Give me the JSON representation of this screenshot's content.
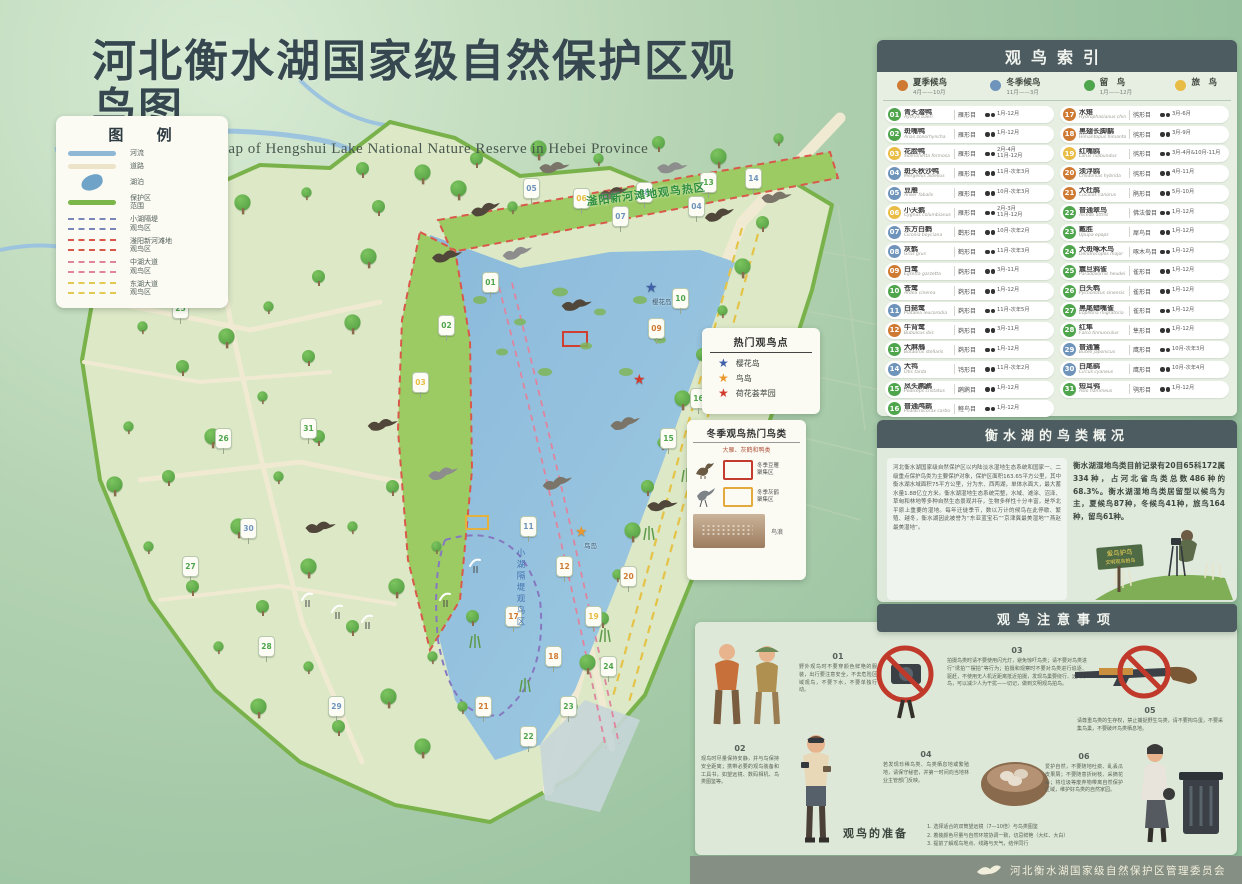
{
  "page": {
    "title": "河北衡水湖国家级自然保护区观鸟图",
    "subtitle": "Bird watching map of Hengshui Lake National Nature Reserve in Hebei Province"
  },
  "colors": {
    "summer": "#cf7a33",
    "winter": "#6f94bb",
    "resident": "#4ea54c",
    "passage": "#e9bd45",
    "header_bar": "#4d5c60",
    "reserve_boundary": "#79b24a",
    "lake": "#8ab9da"
  },
  "legend": {
    "title": "图  例",
    "items": [
      {
        "label": "河流",
        "type": "line",
        "color": "#8fb8d4"
      },
      {
        "label": "道路",
        "type": "line",
        "color": "#ece3c8"
      },
      {
        "label": "湖泊",
        "type": "blob",
        "color": "#6fa3c8"
      },
      {
        "label": "保护区\n范围",
        "type": "line",
        "color": "#7ab648"
      },
      {
        "label": "小湖隔堤\n观鸟区",
        "type": "dash",
        "color": "#7a86b8"
      },
      {
        "label": "滏阳新河滩地\n观鸟区",
        "type": "dash",
        "color": "#d9584a"
      },
      {
        "label": "中湖大道\n观鸟区",
        "type": "dash",
        "color": "#e0849e"
      },
      {
        "label": "东湖大道\n观鸟区",
        "type": "dash",
        "color": "#e2ca52"
      }
    ]
  },
  "map": {
    "labels": {
      "fuyang": "滏阳新河滩地观鸟热区",
      "xiaohu": "小湖隔堤观鸟区",
      "yinghua": "樱花岛",
      "niaodao": "鸟岛"
    },
    "markers": [
      {
        "n": "01",
        "x": 482,
        "y": 272
      },
      {
        "n": "02",
        "x": 438,
        "y": 315
      },
      {
        "n": "03",
        "x": 412,
        "y": 372
      },
      {
        "n": "04",
        "x": 688,
        "y": 196
      },
      {
        "n": "05",
        "x": 523,
        "y": 178
      },
      {
        "n": "06",
        "x": 573,
        "y": 188
      },
      {
        "n": "07",
        "x": 612,
        "y": 206
      },
      {
        "n": "08",
        "x": 636,
        "y": 182
      },
      {
        "n": "09",
        "x": 648,
        "y": 318
      },
      {
        "n": "10",
        "x": 672,
        "y": 288
      },
      {
        "n": "11",
        "x": 520,
        "y": 516
      },
      {
        "n": "12",
        "x": 556,
        "y": 556
      },
      {
        "n": "13",
        "x": 700,
        "y": 172
      },
      {
        "n": "14",
        "x": 745,
        "y": 168
      },
      {
        "n": "15",
        "x": 660,
        "y": 428
      },
      {
        "n": "16",
        "x": 690,
        "y": 388
      },
      {
        "n": "17",
        "x": 505,
        "y": 606
      },
      {
        "n": "18",
        "x": 545,
        "y": 646
      },
      {
        "n": "19",
        "x": 585,
        "y": 606
      },
      {
        "n": "20",
        "x": 620,
        "y": 566
      },
      {
        "n": "21",
        "x": 475,
        "y": 696
      },
      {
        "n": "22",
        "x": 520,
        "y": 726
      },
      {
        "n": "23",
        "x": 560,
        "y": 696
      },
      {
        "n": "24",
        "x": 600,
        "y": 656
      },
      {
        "n": "25",
        "x": 172,
        "y": 298
      },
      {
        "n": "26",
        "x": 215,
        "y": 428
      },
      {
        "n": "27",
        "x": 182,
        "y": 556
      },
      {
        "n": "28",
        "x": 258,
        "y": 636
      },
      {
        "n": "29",
        "x": 328,
        "y": 696
      },
      {
        "n": "30",
        "x": 240,
        "y": 518
      },
      {
        "n": "31",
        "x": 300,
        "y": 418
      }
    ],
    "stars": [
      {
        "x": 645,
        "y": 281,
        "color": "#3f5fa8"
      },
      {
        "x": 575,
        "y": 525,
        "color": "#e8982c"
      },
      {
        "x": 633,
        "y": 373,
        "color": "#d23a2e"
      }
    ]
  },
  "hotspot": {
    "title": "热门观鸟点",
    "items": [
      {
        "label": "樱花岛",
        "color": "#3f5fa8"
      },
      {
        "label": "鸟岛",
        "color": "#e8982c"
      },
      {
        "label": "荷花荟萃园",
        "color": "#d23a2e"
      }
    ]
  },
  "winter": {
    "title": "冬季观鸟热门鸟类",
    "subtitle": "大雁、灰鹤和鸭类",
    "items": [
      {
        "label": "冬季豆雁\n聚集区",
        "color": "#c23b2e",
        "icon": "goose"
      },
      {
        "label": "冬季灰鹤\n聚集区",
        "color": "#e4a93c",
        "icon": "crane"
      }
    ],
    "photo_label": "鸟浪"
  },
  "index": {
    "title": "观鸟索引",
    "seasons": [
      {
        "label": "夏季候鸟",
        "dates": "4月——10月",
        "season": "summer"
      },
      {
        "label": "冬季候鸟",
        "dates": "11月——3月",
        "season": "winter"
      },
      {
        "label": "留　鸟",
        "dates": "1月——12月",
        "season": "resident"
      },
      {
        "label": "旅　鸟",
        "dates": "",
        "season": "passage"
      }
    ],
    "birds": [
      {
        "no": "01",
        "name": "青头潜鸭",
        "latin": "Aythya baeri",
        "order": "雁形目",
        "months": "1月-12月",
        "season": "resident"
      },
      {
        "no": "02",
        "name": "斑嘴鸭",
        "latin": "Anas zonorhyncha",
        "order": "雁形目",
        "months": "1月-12月",
        "season": "resident"
      },
      {
        "no": "03",
        "name": "花脸鸭",
        "latin": "Sibirionetta formosa",
        "order": "雁形目",
        "months": "2月-4月\n11月-12月",
        "season": "passage"
      },
      {
        "no": "04",
        "name": "斑头秋沙鸭",
        "latin": "Mergellus albellus",
        "order": "雁形目",
        "months": "11月-次年3月",
        "season": "winter"
      },
      {
        "no": "05",
        "name": "豆雁",
        "latin": "Anser fabalis",
        "order": "雁形目",
        "months": "10月-次年3月",
        "season": "winter"
      },
      {
        "no": "06",
        "name": "小天鹅",
        "latin": "Cygnus columbianus",
        "order": "雁形目",
        "months": "2月-3月\n11月-12月",
        "season": "passage"
      },
      {
        "no": "07",
        "name": "东方白鹳",
        "latin": "Ciconia boyciana",
        "order": "鹳形目",
        "months": "10月-次年2月",
        "season": "winter"
      },
      {
        "no": "08",
        "name": "灰鹤",
        "latin": "Grus grus",
        "order": "鹤形目",
        "months": "11月-次年3月",
        "season": "winter"
      },
      {
        "no": "09",
        "name": "白鹭",
        "latin": "Egretta garzetta",
        "order": "鹈形目",
        "months": "3月-11月",
        "season": "summer"
      },
      {
        "no": "10",
        "name": "苍鹭",
        "latin": "Ardea cinerea",
        "order": "鹈形目",
        "months": "1月-12月",
        "season": "resident"
      },
      {
        "no": "11",
        "name": "白琵鹭",
        "latin": "Platalea leucorodia",
        "order": "鹈形目",
        "months": "11月-次年5月",
        "season": "winter"
      },
      {
        "no": "12",
        "name": "牛背鹭",
        "latin": "Bubulcus ibis",
        "order": "鹈形目",
        "months": "3月-11月",
        "season": "summer"
      },
      {
        "no": "13",
        "name": "大麻鳽",
        "latin": "Botaurus stellaris",
        "order": "鹈形目",
        "months": "1月-12月",
        "season": "resident"
      },
      {
        "no": "14",
        "name": "大鸨",
        "latin": "Otis tarda",
        "order": "鸨形目",
        "months": "11月-次年2月",
        "season": "winter"
      },
      {
        "no": "15",
        "name": "凤头䴙䴘",
        "latin": "Podiceps cristatus",
        "order": "䴙䴘目",
        "months": "1月-12月",
        "season": "resident"
      },
      {
        "no": "16",
        "name": "普通鸬鹚",
        "latin": "Phalacrocorax carbo",
        "order": "鲣鸟目",
        "months": "1月-12月",
        "season": "resident"
      },
      {
        "no": "17",
        "name": "水雉",
        "latin": "Hydrophasianus chirurgus",
        "order": "鸻形目",
        "months": "3月-6月",
        "season": "summer"
      },
      {
        "no": "18",
        "name": "黑翅长脚鹬",
        "latin": "Himantopus himantopus",
        "order": "鸻形目",
        "months": "3月-9月",
        "season": "summer"
      },
      {
        "no": "19",
        "name": "红嘴鸥",
        "latin": "Larus ridibundus",
        "order": "鸻形目",
        "months": "3月-4月&10月-11月",
        "season": "passage"
      },
      {
        "no": "20",
        "name": "须浮鸥",
        "latin": "Chlidonias hybrida",
        "order": "鸻形目",
        "months": "4月-11月",
        "season": "summer"
      },
      {
        "no": "21",
        "name": "大杜鹃",
        "latin": "Cuculus canorus",
        "order": "鹃形目",
        "months": "5月-10月",
        "season": "summer"
      },
      {
        "no": "22",
        "name": "普通翠鸟",
        "latin": "Alcedo atthis",
        "order": "佛法僧目",
        "months": "1月-12月",
        "season": "resident"
      },
      {
        "no": "23",
        "name": "戴胜",
        "latin": "Upupa epops",
        "order": "犀鸟目",
        "months": "1月-12月",
        "season": "resident"
      },
      {
        "no": "24",
        "name": "大斑啄木鸟",
        "latin": "Dendrocopos major",
        "order": "啄木鸟目",
        "months": "1月-12月",
        "season": "resident"
      },
      {
        "no": "25",
        "name": "震旦鸦雀",
        "latin": "Paradoxornis heudei",
        "order": "雀形目",
        "months": "1月-12月",
        "season": "resident"
      },
      {
        "no": "26",
        "name": "白头鹎",
        "latin": "Pycnonotus sinensis",
        "order": "雀形目",
        "months": "1月-12月",
        "season": "resident"
      },
      {
        "no": "27",
        "name": "黑尾蜡嘴雀",
        "latin": "Eophona migratoria",
        "order": "雀形目",
        "months": "1月-12月",
        "season": "resident"
      },
      {
        "no": "28",
        "name": "红隼",
        "latin": "Falco tinnunculus",
        "order": "隼形目",
        "months": "1月-12月",
        "season": "resident"
      },
      {
        "no": "29",
        "name": "普通鵟",
        "latin": "Buteo japonicus",
        "order": "鹰形目",
        "months": "10月-次年3月",
        "season": "winter"
      },
      {
        "no": "30",
        "name": "白尾鹞",
        "latin": "Circus cyaneus",
        "order": "鹰形目",
        "months": "10月-次年4月",
        "season": "winter"
      },
      {
        "no": "31",
        "name": "短耳鸮",
        "latin": "Asio flammeus",
        "order": "鸮形目",
        "months": "1月-12月",
        "season": "resident"
      }
    ]
  },
  "overview": {
    "title": "衡水湖的鸟类概况",
    "paragraph": "河北衡水湖国家级自然保护区以内陆淡水湿地生态系统和国家一、二级重点保护鸟类为主要保护对象，保护区面积163.65平方公里，其中衡水湖水域面积75平方公里，分为东、西两湖，单体水面大，最大蓄水量1.88亿立方米。衡水湖湿地生态系统完整，水域、滩涂、沼泽、草甸和林地等多种自然生态景观并存，生物多样性十分丰富，是华北平原上重要的湿地。每年迁徙季节，数以万计的候鸟在此停歇、繁殖、越冬，衡水湖因此被誉为“东亚蓝宝石”“京津冀最美湿地”“燕赵最美湿地”。",
    "stats": "衡水湖湿地鸟类目前记录有20目65科172属334种，占河北省鸟类总数486种的68.3%。衡水湖湿地鸟类居留型以候鸟为主，夏候鸟87种，冬候鸟41种，旅鸟164种，留鸟61种。",
    "sign_line1": "爱鸟护鸟",
    "sign_line2": "文明观鸟拍鸟"
  },
  "notes": {
    "title": "观鸟注意事项",
    "items": [
      {
        "no": "01",
        "text": "野外观鸟时不要穿颜色鲜艳的服装，出行要注意安全，不去危险区域观鸟，不要下水，不要单独行动。"
      },
      {
        "no": "02",
        "text": "观鸟时尽量保持安静，并与鸟保持安全距离；携带必要的观鸟装备和工具书，如望远镜、数码相机、鸟类图鉴等。"
      },
      {
        "no": "03",
        "text": "拍摄鸟类时请不要使用闪光灯，避免惊吓鸟类；请不要对鸟类进行“诱拍”“摆拍”等行为；拍摄和观察时不要对鸟类进行追逐、驱赶，不使用无人机近距离抵近拍摄，发现鸟巢要绕行、远离雏鸟，可以减少人为干扰——切记，做到文明观鸟拍鸟。"
      },
      {
        "no": "04",
        "text": "若发现珍稀鸟类、鸟类栖息地或繁殖地，请保守秘密，并第一时间向当地林业主管部门反映。"
      },
      {
        "no": "05",
        "text": "请尊重鸟类的生存权，禁止捕捉野生鸟类，请不要掏鸟蛋，不要采集鸟巢，不要破坏鸟类栖息地。"
      },
      {
        "no": "06",
        "text": "爱护自然，不要随地吐痰、乱丢瓜皮果屑；不要随意折树枝、采摘花朵；将垃圾等废弃物带离自然保护区域，维护好鸟类的自然家园。"
      }
    ],
    "prep": {
      "title": "观鸟的准备",
      "lines": [
        "1. 选择适合的双筒望远镜（7—10倍）与鸟类图鉴",
        "2. 着装颜色尽量与自然环境协调一致，切忌鲜艳（大红、大白）",
        "3. 提前了解观鸟地点、线路与天气，结伴同行"
      ]
    }
  },
  "footer": {
    "org": "河北衡水湖国家级自然保护区管理委员会"
  }
}
